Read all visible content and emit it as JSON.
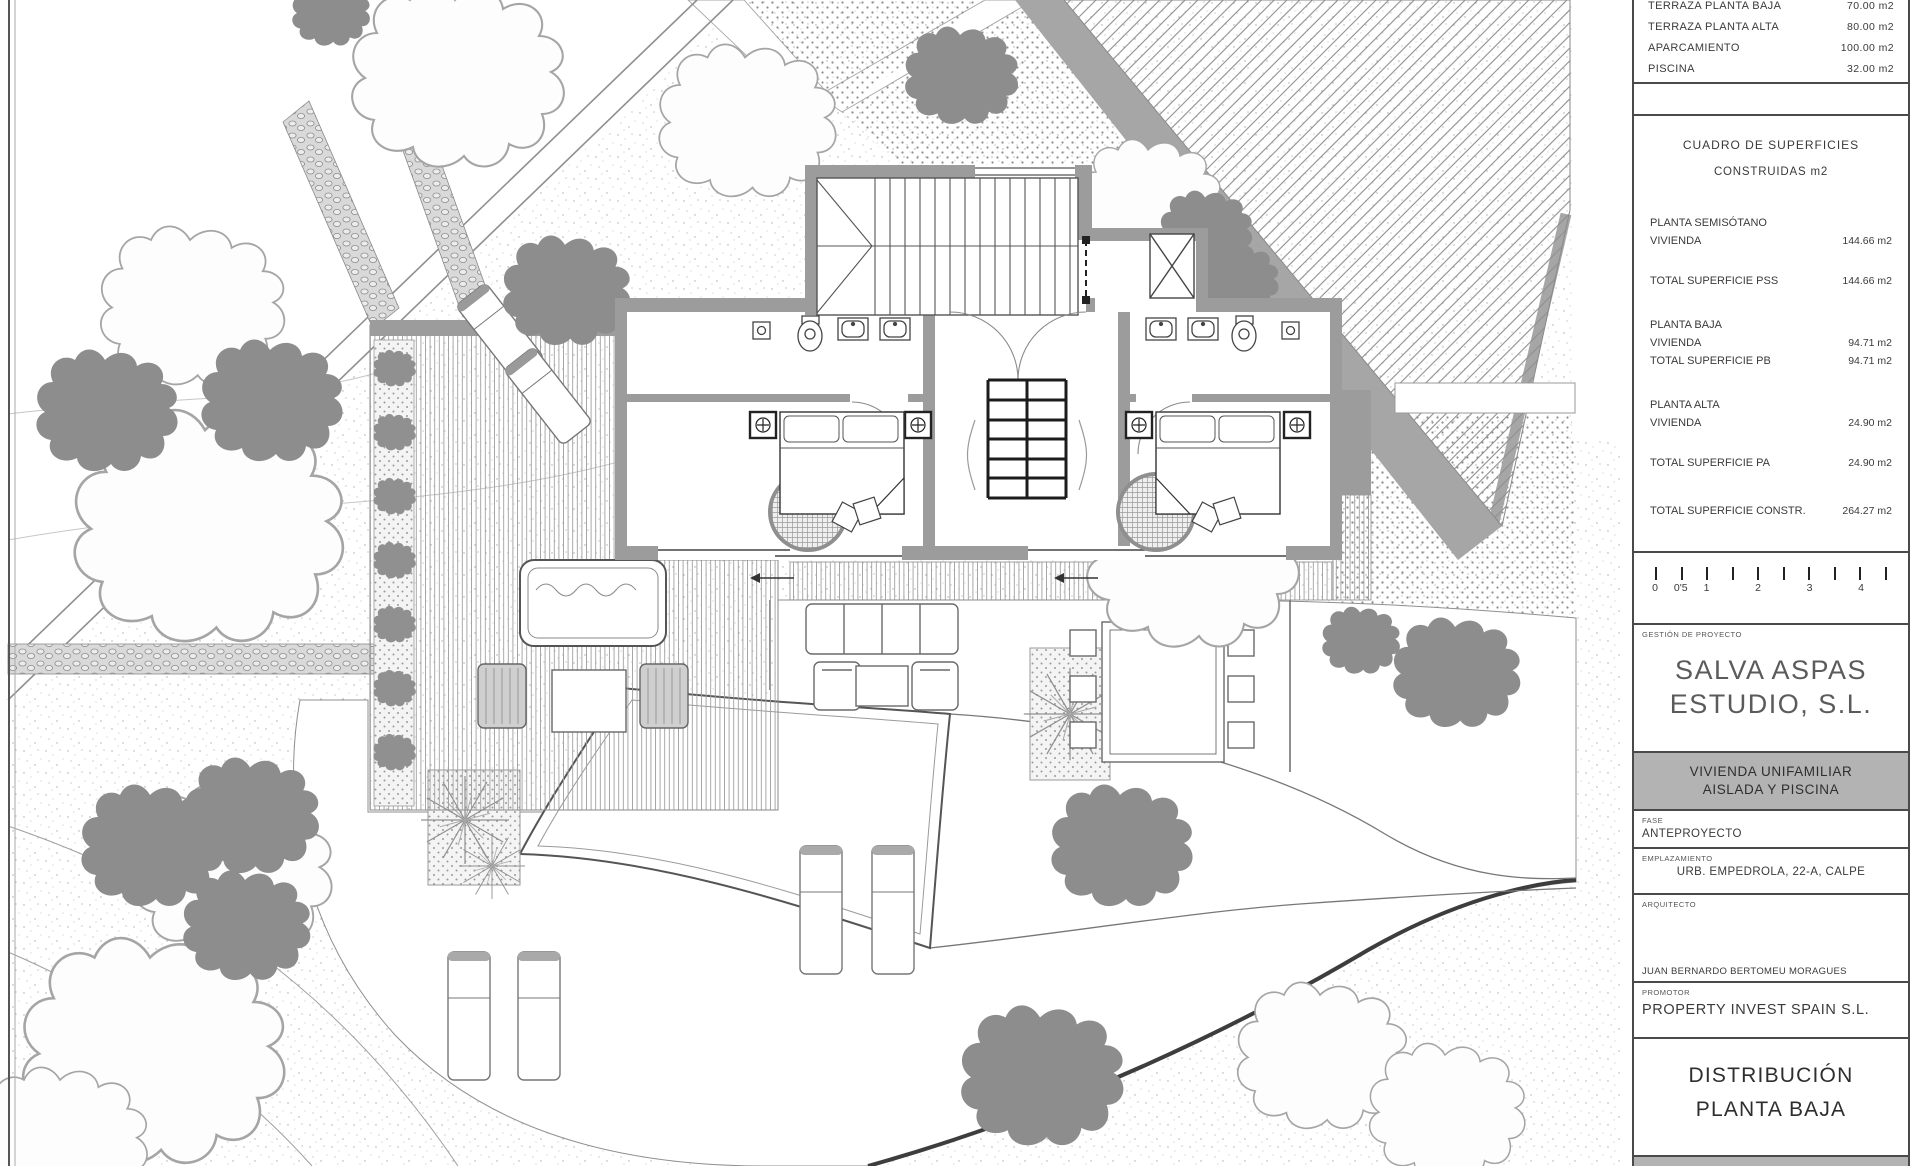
{
  "title_block": {
    "surface_table": {
      "rows": [
        {
          "label": "TERRAZA PLANTA BAJA",
          "value": "70.00 m2"
        },
        {
          "label": "TERRAZA PLANTA ALTA",
          "value": "80.00 m2"
        },
        {
          "label": "APARCAMIENTO",
          "value": "100.00 m2"
        },
        {
          "label": "PISCINA",
          "value": "32.00 m2"
        }
      ]
    },
    "cuadro": {
      "title": "CUADRO DE SUPERFICIES",
      "subtitle": "CONSTRUIDAS m2",
      "rows": [
        {
          "label": "PLANTA SEMISÓTANO",
          "value": ""
        },
        {
          "label": "VIVIENDA",
          "value": "144.66 m2"
        },
        {
          "label": "TOTAL SUPERFICIE PSS",
          "value": "144.66 m2"
        },
        {
          "label": "PLANTA BAJA",
          "value": ""
        },
        {
          "label": "VIVIENDA",
          "value": "94.71 m2"
        },
        {
          "label": "TOTAL SUPERFICIE PB",
          "value": "94.71 m2"
        },
        {
          "label": "PLANTA ALTA",
          "value": ""
        },
        {
          "label": "VIVIENDA",
          "value": "24.90 m2"
        },
        {
          "label": "TOTAL SUPERFICIE PA",
          "value": "24.90 m2"
        },
        {
          "label": "TOTAL SUPERFICIE CONSTR.",
          "value": "264.27 m2"
        }
      ]
    },
    "scale_bar": {
      "labels": [
        "0",
        "0'5",
        "1",
        "2",
        "3",
        "4"
      ]
    },
    "gestion_label": "GESTIÓN DE PROYECTO",
    "studio_name_line1": "SALVA ASPAS",
    "studio_name_line2": "ESTUDIO, S.L.",
    "project_title_line1": "VIVIENDA UNIFAMILIAR",
    "project_title_line2": "AISLADA Y PISCINA",
    "fase_label": "FASE",
    "fase_value": "ANTEPROYECTO",
    "emplazamiento_label": "EMPLAZAMIENTO",
    "emplazamiento_value": "URB. EMPEDROLA, 22-A, CALPE",
    "arquitecto_label": "ARQUITECTO",
    "arquitecto_value": "JUAN BERNARDO BERTOMEU MORAGUES",
    "promotor_label": "PROMOTOR",
    "promotor_value": "PROPERTY INVEST SPAIN S.L.",
    "sheet_title_line1": "DISTRIBUCIÓN",
    "sheet_title_line2": "PLANTA BAJA"
  },
  "colors": {
    "wall_gray": "#9c9c9c",
    "road_gray": "#a6a6a6",
    "banner_gray": "#b3b3b3",
    "dark_line": "#3d3d3d",
    "text": "#3a3a3a"
  }
}
